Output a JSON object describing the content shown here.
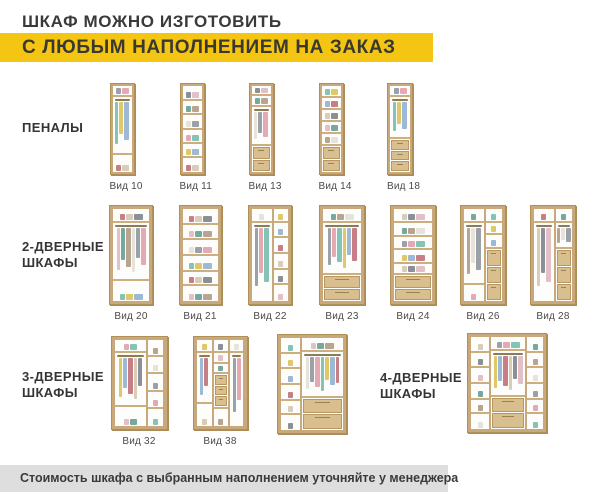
{
  "header": {
    "title": "ШКАФ МОЖНО ИЗГОТОВИТЬ",
    "banner": "С ЛЮБЫМ НАПОЛНЕНИЕМ НА ЗАКАЗ"
  },
  "footer": {
    "note": "Стоимость шкафа с выбранным наполнением уточняйте у менеджера"
  },
  "colors": {
    "accent_yellow": "#f5c513",
    "wood": "#c9a97b",
    "wood_dark": "#b09057",
    "drawer_face": "#d9be8e",
    "footer_bg": "#dedede",
    "text_dark": "#3a3a3c",
    "clothes_palette": [
      "#9aa1a9",
      "#e5a9b4",
      "#85c3b4",
      "#dfc868",
      "#9db9d6",
      "#c77e85",
      "#d9cdb9",
      "#8b8f98",
      "#e3bfc7",
      "#76a8a0",
      "#b9a58f",
      "#e8e3da"
    ]
  },
  "groups": [
    {
      "name": "pencil-cases",
      "label_lines": [
        "ПЕНАЛЫ"
      ],
      "items": [
        {
          "label": "Вид 10",
          "cx": 122,
          "top": 83,
          "w": 25,
          "h": 92,
          "cols": [
            {
              "w": 100,
              "cells": [
                {
                  "k": "box",
                  "h": 13
                },
                {
                  "k": "hang",
                  "h": 67
                },
                {
                  "k": "box",
                  "h": 20
                }
              ]
            }
          ]
        },
        {
          "label": "Вид 11",
          "cx": 192,
          "top": 83,
          "w": 25,
          "h": 92,
          "cols": [
            {
              "w": 100,
              "cells": [
                {
                  "k": "box",
                  "h": 17
                },
                {
                  "k": "box",
                  "h": 17
                },
                {
                  "k": "box",
                  "h": 17
                },
                {
                  "k": "box",
                  "h": 17
                },
                {
                  "k": "box",
                  "h": 16
                },
                {
                  "k": "box",
                  "h": 16
                }
              ]
            }
          ]
        },
        {
          "label": "Вид 13",
          "cx": 261,
          "top": 83,
          "w": 25,
          "h": 92,
          "cols": [
            {
              "w": 100,
              "cells": [
                {
                  "k": "box",
                  "h": 12
                },
                {
                  "k": "box",
                  "h": 12
                },
                {
                  "k": "hang",
                  "h": 46
                },
                {
                  "k": "drawers",
                  "n": 2,
                  "h": 30
                }
              ]
            }
          ]
        },
        {
          "label": "Вид 14",
          "cx": 331,
          "top": 83,
          "w": 25,
          "h": 92,
          "cols": [
            {
              "w": 100,
              "cells": [
                {
                  "k": "box",
                  "h": 14
                },
                {
                  "k": "box",
                  "h": 14
                },
                {
                  "k": "box",
                  "h": 14
                },
                {
                  "k": "box",
                  "h": 14
                },
                {
                  "k": "box",
                  "h": 14
                },
                {
                  "k": "drawers",
                  "n": 2,
                  "h": 30
                }
              ]
            }
          ]
        },
        {
          "label": "Вид 18",
          "cx": 400,
          "top": 83,
          "w": 26,
          "h": 92,
          "cols": [
            {
              "w": 100,
              "cells": [
                {
                  "k": "box",
                  "h": 13
                },
                {
                  "k": "hang",
                  "h": 49
                },
                {
                  "k": "drawers",
                  "n": 3,
                  "h": 38
                }
              ]
            }
          ]
        }
      ]
    },
    {
      "name": "2-door",
      "label_lines": [
        "2-ДВЕРНЫЕ",
        "ШКАФЫ"
      ],
      "items": [
        {
          "label": "Вид 20",
          "cx": 131,
          "top": 205,
          "w": 44,
          "h": 100,
          "cols": [
            {
              "w": 100,
              "cells": [
                {
                  "k": "box",
                  "h": 15
                },
                {
                  "k": "hang",
                  "h": 63
                },
                {
                  "k": "box",
                  "h": 22
                }
              ]
            }
          ]
        },
        {
          "label": "Вид 21",
          "cx": 200,
          "top": 205,
          "w": 43,
          "h": 100,
          "cols": [
            {
              "w": 100,
              "cells": [
                {
                  "k": "box",
                  "h": 17
                },
                {
                  "k": "box",
                  "h": 17
                },
                {
                  "k": "box",
                  "h": 17
                },
                {
                  "k": "box",
                  "h": 17
                },
                {
                  "k": "box",
                  "h": 16
                },
                {
                  "k": "box",
                  "h": 16
                }
              ]
            }
          ]
        },
        {
          "label": "Вид 22",
          "cx": 270,
          "top": 205,
          "w": 44,
          "h": 100,
          "cols": [
            {
              "w": 55,
              "cells": [
                {
                  "k": "box",
                  "h": 15
                },
                {
                  "k": "hang",
                  "h": 85
                }
              ]
            },
            {
              "w": 45,
              "cells": [
                {
                  "k": "box",
                  "h": 15
                },
                {
                  "k": "box",
                  "h": 17
                },
                {
                  "k": "box",
                  "h": 17
                },
                {
                  "k": "box",
                  "h": 17
                },
                {
                  "k": "box",
                  "h": 17
                },
                {
                  "k": "box",
                  "h": 17
                }
              ]
            }
          ]
        },
        {
          "label": "Вид 23",
          "cx": 342,
          "top": 205,
          "w": 46,
          "h": 100,
          "cols": [
            {
              "w": 100,
              "cells": [
                {
                  "k": "box",
                  "h": 15
                },
                {
                  "k": "hang",
                  "h": 57
                },
                {
                  "k": "drawers",
                  "n": 2,
                  "h": 28
                }
              ]
            }
          ]
        },
        {
          "label": "Вид 24",
          "cx": 413,
          "top": 205,
          "w": 46,
          "h": 100,
          "cols": [
            {
              "w": 100,
              "cells": [
                {
                  "k": "box",
                  "h": 15
                },
                {
                  "k": "box",
                  "h": 15
                },
                {
                  "k": "box",
                  "h": 15
                },
                {
                  "k": "box",
                  "h": 15
                },
                {
                  "k": "box",
                  "h": 12
                },
                {
                  "k": "drawers",
                  "n": 2,
                  "h": 28
                }
              ]
            }
          ]
        },
        {
          "label": "Вид 26",
          "cx": 483,
          "top": 205,
          "w": 46,
          "h": 100,
          "cols": [
            {
              "w": 52,
              "cells": [
                {
                  "k": "box",
                  "h": 15
                },
                {
                  "k": "hang",
                  "h": 68
                },
                {
                  "k": "box",
                  "h": 17
                }
              ]
            },
            {
              "w": 48,
              "cells": [
                {
                  "k": "box",
                  "h": 15
                },
                {
                  "k": "box",
                  "h": 13
                },
                {
                  "k": "box",
                  "h": 15
                },
                {
                  "k": "drawers",
                  "n": 3,
                  "h": 57
                }
              ]
            }
          ]
        },
        {
          "label": "Вид 28",
          "cx": 553,
          "top": 205,
          "w": 46,
          "h": 100,
          "cols": [
            {
              "w": 52,
              "cells": [
                {
                  "k": "box",
                  "h": 15
                },
                {
                  "k": "hang",
                  "h": 85
                }
              ]
            },
            {
              "w": 48,
              "cells": [
                {
                  "k": "box",
                  "h": 15
                },
                {
                  "k": "hang",
                  "h": 28
                },
                {
                  "k": "drawers",
                  "n": 3,
                  "h": 57
                }
              ]
            }
          ]
        }
      ]
    },
    {
      "name": "3-door",
      "label_lines": [
        "3-ДВЕРНЫЕ",
        "ШКАФЫ"
      ],
      "items": [
        {
          "label": "Вид 32",
          "cx": 139,
          "top": 336,
          "w": 57,
          "h": 94,
          "cols": [
            {
              "w": 65,
              "cells": [
                {
                  "k": "box",
                  "h": 15
                },
                {
                  "k": "hang",
                  "h": 63
                },
                {
                  "k": "box",
                  "h": 22
                }
              ]
            },
            {
              "w": 35,
              "cells": [
                {
                  "k": "box",
                  "h": 20
                },
                {
                  "k": "box",
                  "h": 20
                },
                {
                  "k": "box",
                  "h": 20
                },
                {
                  "k": "box",
                  "h": 20
                },
                {
                  "k": "box",
                  "h": 20
                }
              ]
            }
          ]
        },
        {
          "label": "Вид 38",
          "cx": 220,
          "top": 336,
          "w": 55,
          "h": 94,
          "cols": [
            {
              "w": 33,
              "cells": [
                {
                  "k": "box",
                  "h": 15
                },
                {
                  "k": "hang",
                  "h": 60
                },
                {
                  "k": "box",
                  "h": 25
                }
              ]
            },
            {
              "w": 34,
              "cells": [
                {
                  "k": "box",
                  "h": 15
                },
                {
                  "k": "box",
                  "h": 13
                },
                {
                  "k": "box",
                  "h": 12
                },
                {
                  "k": "drawers",
                  "n": 3,
                  "h": 40
                },
                {
                  "k": "box",
                  "h": 20
                }
              ]
            },
            {
              "w": 33,
              "cells": [
                {
                  "k": "box",
                  "h": 15
                },
                {
                  "k": "hang",
                  "h": 85
                }
              ]
            }
          ]
        },
        {
          "label": "",
          "cx": 312,
          "top": 334,
          "w": 70,
          "h": 100,
          "cols": [
            {
              "w": 30,
              "cells": [
                {
                  "k": "box",
                  "h": 17
                },
                {
                  "k": "box",
                  "h": 17
                },
                {
                  "k": "box",
                  "h": 17
                },
                {
                  "k": "box",
                  "h": 17
                },
                {
                  "k": "box",
                  "h": 16
                },
                {
                  "k": "box",
                  "h": 16
                }
              ]
            },
            {
              "w": 70,
              "cells": [
                {
                  "k": "box",
                  "h": 15
                },
                {
                  "k": "hang",
                  "h": 50
                },
                {
                  "k": "drawers",
                  "n": 2,
                  "h": 35
                }
              ]
            }
          ]
        }
      ]
    },
    {
      "name": "4-door",
      "label_lines": [
        "4-ДВЕРНЫЕ",
        "ШКАФЫ"
      ],
      "items": [
        {
          "label": "",
          "cx": 507,
          "top": 333,
          "w": 80,
          "h": 100,
          "cols": [
            {
              "w": 25,
              "cells": [
                {
                  "k": "box",
                  "h": 17
                },
                {
                  "k": "box",
                  "h": 17
                },
                {
                  "k": "box",
                  "h": 17
                },
                {
                  "k": "box",
                  "h": 17
                },
                {
                  "k": "box",
                  "h": 16
                },
                {
                  "k": "box",
                  "h": 16
                }
              ]
            },
            {
              "w": 50,
              "cells": [
                {
                  "k": "box",
                  "h": 15
                },
                {
                  "k": "hang",
                  "h": 50
                },
                {
                  "k": "drawers",
                  "n": 2,
                  "h": 35
                }
              ]
            },
            {
              "w": 25,
              "cells": [
                {
                  "k": "box",
                  "h": 17
                },
                {
                  "k": "box",
                  "h": 17
                },
                {
                  "k": "box",
                  "h": 17
                },
                {
                  "k": "box",
                  "h": 17
                },
                {
                  "k": "box",
                  "h": 16
                },
                {
                  "k": "box",
                  "h": 16
                }
              ]
            }
          ]
        }
      ]
    }
  ]
}
